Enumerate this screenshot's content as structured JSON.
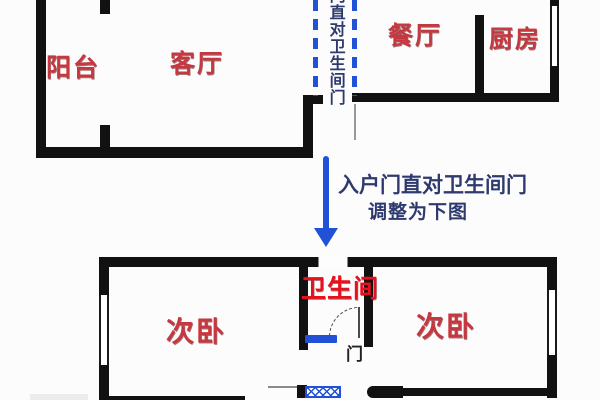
{
  "colors": {
    "wall": "#111111",
    "label_red": "#c63840",
    "bath_red": "#e8101c",
    "blue": "#2151d6",
    "navy": "#2e3a6e"
  },
  "upper_plan": {
    "balcony": "阳台",
    "living_room": "客厅",
    "dining_room": "餐厅",
    "kitchen": "厨房",
    "corridor_vertical_note": "门直对卫生间门"
  },
  "annotation": {
    "line1": "入户门直对卫生间门",
    "line2": "调整为下图",
    "arrow_icon": "down-arrow"
  },
  "lower_plan": {
    "bathroom": "卫生间",
    "bedroom_left": "次卧",
    "bedroom_right": "次卧",
    "door_label": "门"
  }
}
